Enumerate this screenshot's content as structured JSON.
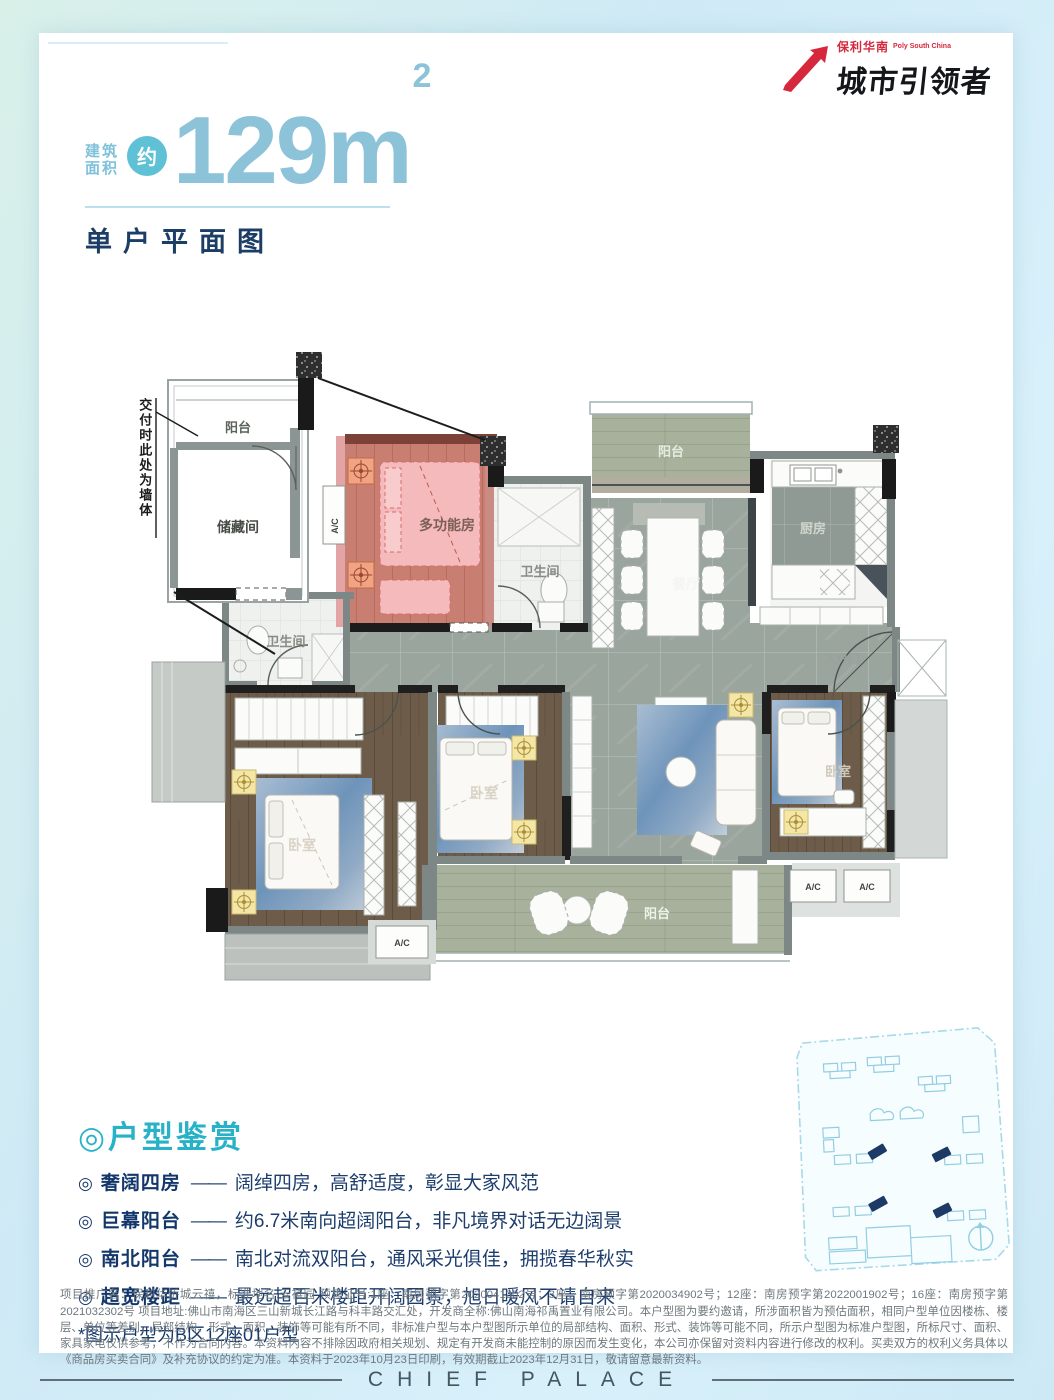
{
  "brand": {
    "cn": "保利华南",
    "en": "Poly South China",
    "wordmark": "城市引领者"
  },
  "title": {
    "area_label_line1": "建筑",
    "area_label_line2": "面积",
    "approx": "约",
    "area_value": "129",
    "area_unit": "m",
    "area_sup": "2",
    "subtitle": "单户平面图"
  },
  "plan": {
    "note_vertical": "交付时此处为墙体",
    "labels": {
      "balcony": "阳台",
      "storage": "储藏间",
      "multi": "多功能房",
      "bath": "卫生间",
      "dining": "餐厅",
      "kitchen": "厨房",
      "entry": "入户门",
      "bedroom": "卧室",
      "ac": "A/C"
    }
  },
  "features": {
    "heading": "◎户型鉴赏",
    "items": [
      {
        "bullet": "◎",
        "name": "奢阔四房",
        "dash": "——",
        "desc": "阔绰四房，高舒适度，彰显大家风范"
      },
      {
        "bullet": "◎",
        "name": "巨幕阳台",
        "dash": "——",
        "desc": "约6.7米南向超阔阳台，非凡境界对话无边阔景"
      },
      {
        "bullet": "◎",
        "name": "南北阳台",
        "dash": "——",
        "desc": "南北对流双阳台，通风采光俱佳，拥揽春华秋实"
      },
      {
        "bullet": "◎",
        "name": "超宽楼距",
        "dash": "——",
        "desc": "最远超百米楼距开阔园景，旭日暖风不请自来"
      }
    ],
    "note": "*图示户型为B区12座01户型"
  },
  "disclaimer": "项目推广名：保利华侨城云禧，标准地名:云禧园 预售证号:1座：南房预字第2020041302号；3座：南房预字第2020034902号；12座：南房预字第2022001902号；16座：南房预字第2021032302号 项目地址:佛山市南海区三山新城长江路与科丰路交汇处，开发商全称:佛山南海祁禹置业有限公司。本户型图为要约邀请，所涉面积皆为预估面积，相同户型单位因楼栋、楼层、单位等差别，局部结构、形式、面积、装饰等可能有所不同，非标准户型与本户型图所示单位的局部结构、面积、形式、装饰等可能不同，所示户型图为标准户型图，所标尺寸、面积、家具家电仅供参考，不作为合同内容。本资料内容不排除因政府相关规划、规定有开发商未能控制的原因而发生变化，本公司亦保留对资料内容进行修改的权利。买卖双方的权利义务具体以《商品房买卖合同》及补充协议的约定为准。本资料于2023年10月23日印刷，有效期截止2023年12月31日，敬请留意最新资料。",
  "footer": {
    "text": "CHIEF PALACE"
  },
  "colors": {
    "accent_teal": "#27b2c7",
    "accent_lightblue": "#8cc3d8",
    "navy": "#1c3e66",
    "brand_red": "#d5283c",
    "highlight_pink": "#e9a9ab"
  }
}
